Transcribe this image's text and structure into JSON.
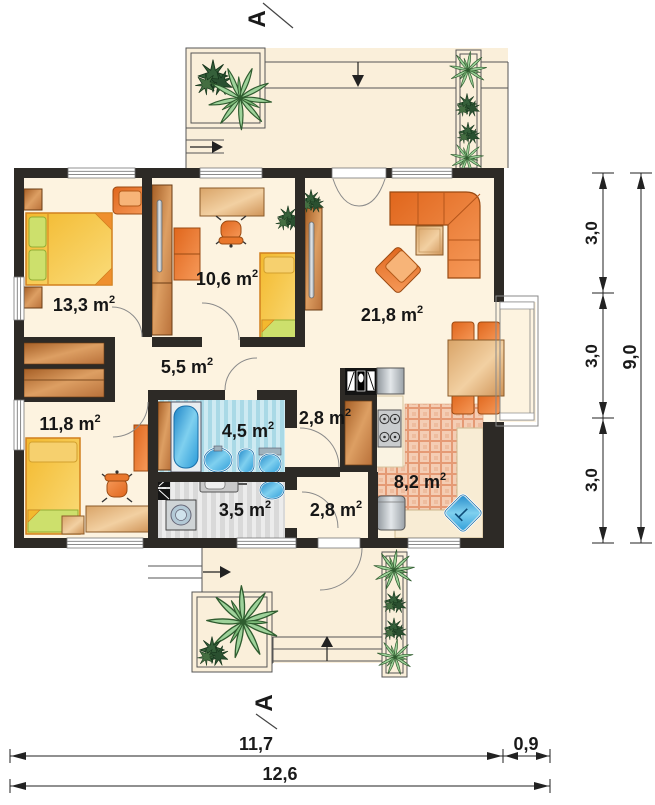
{
  "labels": {
    "rooms": [
      {
        "name": "bedroom-large",
        "label": "13,3 m",
        "sup": "2"
      },
      {
        "name": "room-middle",
        "label": "10,6 m",
        "sup": "2"
      },
      {
        "name": "living-room",
        "label": "21,8 m",
        "sup": "2"
      },
      {
        "name": "hallway",
        "label": "5,5 m",
        "sup": "2"
      },
      {
        "name": "bedroom-small",
        "label": "11,8 m",
        "sup": "2"
      },
      {
        "name": "bathroom",
        "label": "4,5 m",
        "sup": "2"
      },
      {
        "name": "hall-top",
        "label": "2,8 m",
        "sup": "2"
      },
      {
        "name": "utility-room",
        "label": "3,5 m",
        "sup": "2"
      },
      {
        "name": "hall-bottom",
        "label": "2,8 m",
        "sup": "2"
      },
      {
        "name": "kitchen",
        "label": "8,2 m",
        "sup": "2"
      }
    ]
  },
  "dimensions": {
    "right_segments": [
      "3,0",
      "3,0",
      "3,0"
    ],
    "right_total": "9,0",
    "bottom_width": "11,7",
    "bottom_bay": "0,9",
    "bottom_total": "12,6"
  },
  "section": {
    "top": "A",
    "bottom": "A"
  },
  "colors": {
    "wall": "#2d2a26",
    "floor": "#fdf3e0",
    "furniture_orange": "#ee7a2a",
    "wood": "#c98546",
    "water_blue": "#2da5dd",
    "plant_green": "#8fcb8a",
    "bath_floor": "#bfe2ec",
    "kitchen_floor": "#f2c7ae",
    "utility_floor": "#dcdcdc"
  }
}
